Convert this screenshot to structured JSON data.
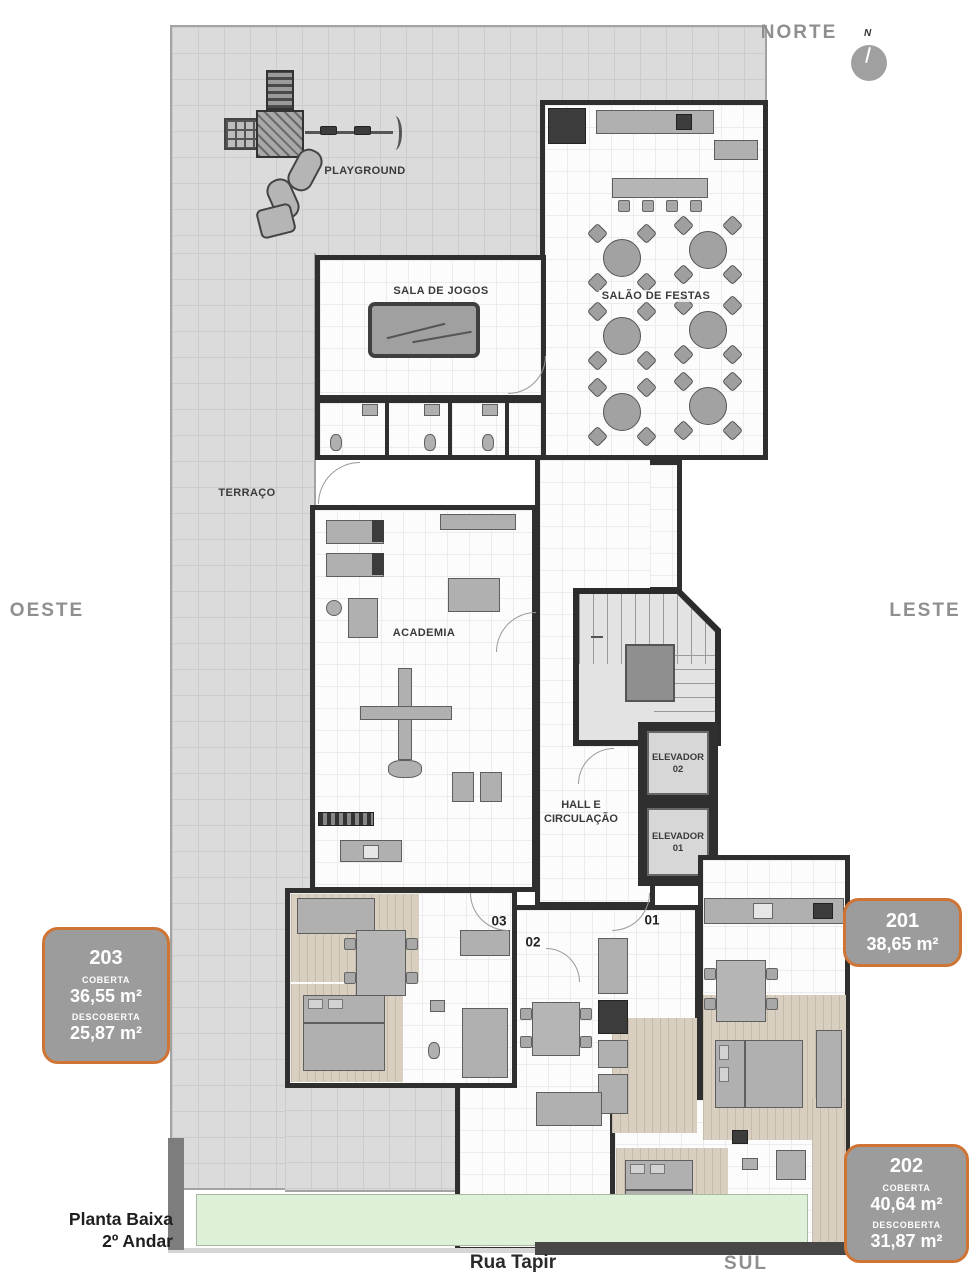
{
  "title": {
    "line1": "Planta Baixa",
    "line2": "2º Andar"
  },
  "street": "Rua Tapir",
  "compass": {
    "north": "NORTE",
    "west": "OESTE",
    "east": "LESTE",
    "south": "SUL",
    "needle": "N"
  },
  "rooms": {
    "playground": "PLAYGROUND",
    "games": "SALA DE JOGOS",
    "party": "SALÃO DE FESTAS",
    "terrace": "TERRAÇO",
    "gym": "ACADEMIA",
    "hall": {
      "line1": "HALL E",
      "line2": "CIRCULAÇÃO"
    },
    "elevator2": {
      "line1": "ELEVADOR",
      "line2": "02"
    },
    "elevator1": {
      "line1": "ELEVADOR",
      "line2": "01"
    }
  },
  "unit_doors": {
    "u03": "03",
    "u02": "02",
    "u01": "01"
  },
  "unit_badges": {
    "b203": {
      "number": "203",
      "covered_label": "COBERTA",
      "covered_area": "36,55 m²",
      "uncovered_label": "DESCOBERTA",
      "uncovered_area": "25,87 m²"
    },
    "b201": {
      "number": "201",
      "area": "38,65 m²"
    },
    "b202": {
      "number": "202",
      "covered_label": "COBERTA",
      "covered_area": "40,64 m²",
      "uncovered_label": "DESCOBERTA",
      "uncovered_area": "31,87 m²"
    }
  },
  "colors": {
    "badge_fill": "#9c9c9c",
    "badge_border": "#cf7434",
    "terrace": "#dbdbdb",
    "wall": "#2f2f2f",
    "wood_floor": "#d9cfc0",
    "garden": "#def0d8",
    "direction_text": "#8f8f8f"
  }
}
